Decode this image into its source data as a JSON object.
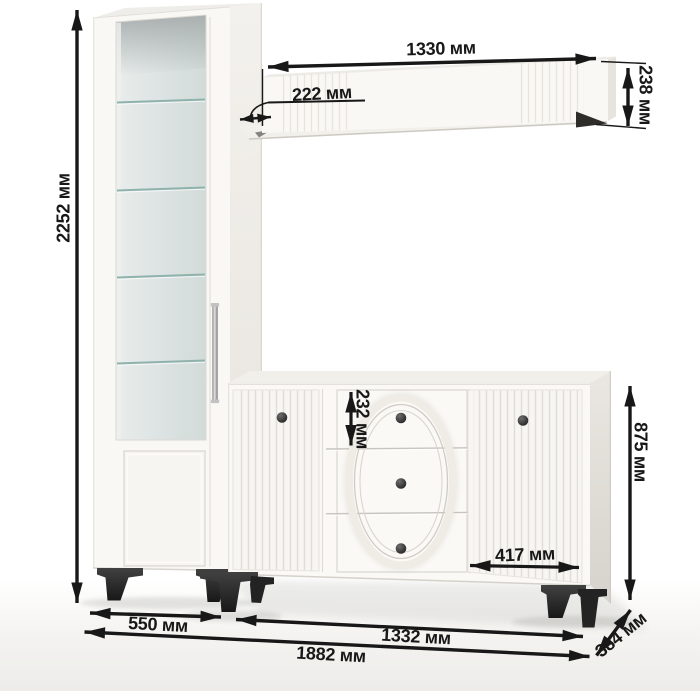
{
  "dims": {
    "cabinet_height": "2252 мм",
    "shelf_length": "1330 мм",
    "shelf_depth": "222 мм",
    "shelf_height": "238 мм",
    "drawer_height": "232 мм",
    "door_width": "417 мм",
    "sideboard_height": "875 мм",
    "sideboard_depth": "384 мм",
    "cabinet_width": "550 мм",
    "sideboard_width": "1332 мм",
    "total_width": "1882 мм"
  },
  "colors": {
    "dimension_ink": "#181818",
    "furniture_white": "#f8f6f2",
    "glass": "#d9e0df",
    "glass_shelf_edge": "#8fb2ac",
    "hardware_dark": "#232323",
    "background": "#ffffff",
    "floor": "#efeeeb"
  }
}
